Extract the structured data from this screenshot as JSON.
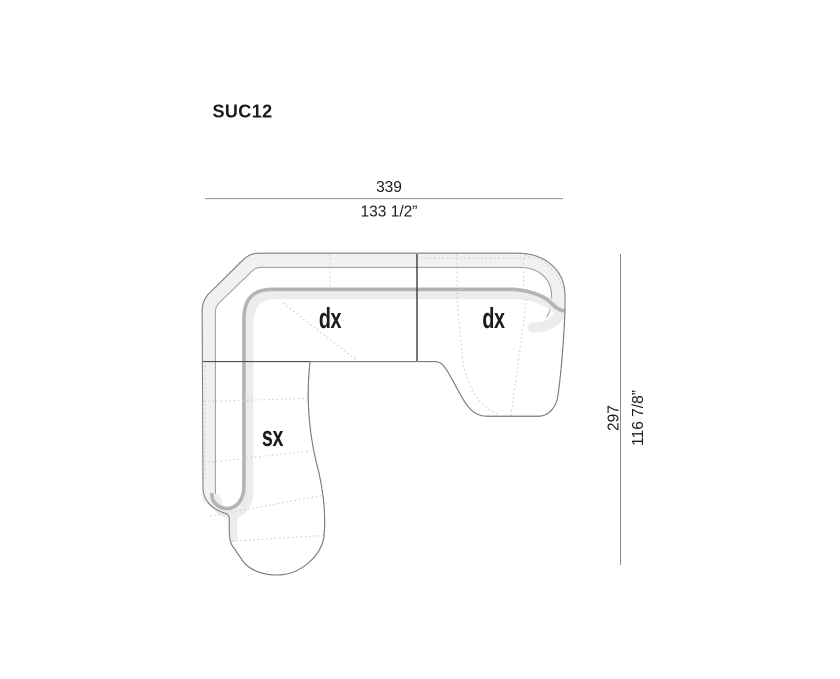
{
  "title": "SUC12",
  "modules": [
    {
      "label": "dx",
      "position": "top-left-corner"
    },
    {
      "label": "dx",
      "position": "top-right-chaise"
    },
    {
      "label": "sx",
      "position": "bottom-left-chaise"
    }
  ],
  "dimensions": {
    "width_cm": "339",
    "width_in": "133 1/2”",
    "depth_cm": "297",
    "depth_in": "116 7/8”"
  },
  "colors": {
    "background": "#ffffff",
    "band_fill": "#f1f1f1",
    "edge_shadow": "#ececec",
    "inner_edge": "#b4b4b4",
    "outline": "#7d7d7d",
    "seam": "#c8c8c8",
    "dimension_line": "#8c8c8c",
    "text": "#1b1b1b"
  }
}
